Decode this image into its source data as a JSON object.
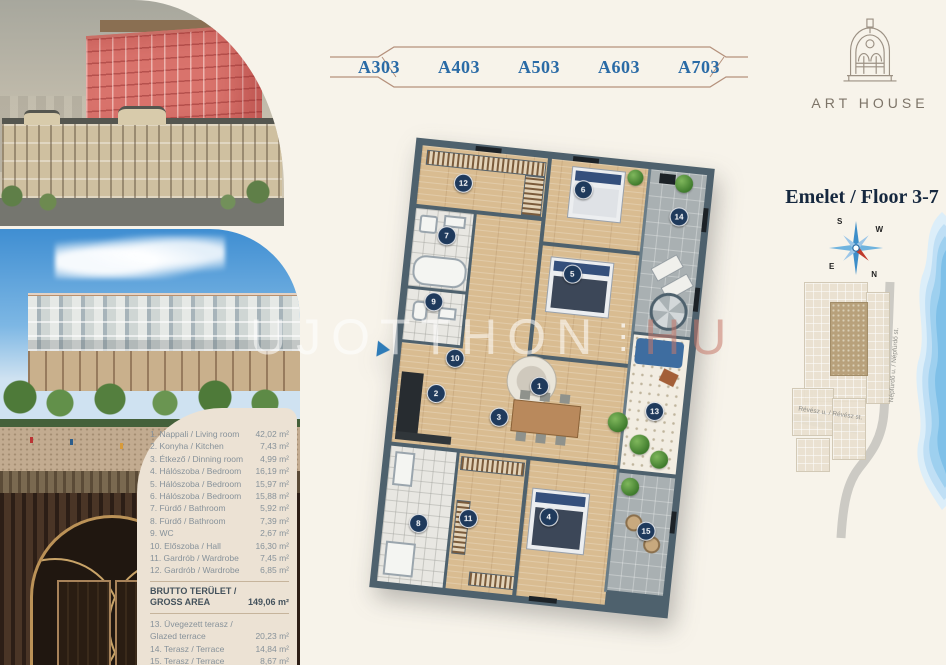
{
  "tabs": {
    "items": [
      {
        "label": "A303"
      },
      {
        "label": "A403"
      },
      {
        "label": "A503"
      },
      {
        "label": "A603"
      },
      {
        "label": "A703"
      }
    ]
  },
  "logo": {
    "text": "ART HOUSE"
  },
  "right_panel": {
    "title": "Emelet / Floor 3-7",
    "compass": {
      "n": "N",
      "s": "S",
      "e": "E",
      "w": "W"
    },
    "sitemap": {
      "street_vertical": "Népfürdő u. / Népfürdő st.",
      "street_horizontal": "Révész u. / Révész st."
    }
  },
  "watermark": {
    "main": "UJOTTHON",
    "dots": "⋮",
    "suffix": "HU"
  },
  "area_table": {
    "rows": [
      {
        "label": "1. Nappali / Living room",
        "area": "42,02 m²"
      },
      {
        "label": "2. Konyha / Kitchen",
        "area": "7,43 m²"
      },
      {
        "label": "3. Étkező / Dinning room",
        "area": "4,99 m²"
      },
      {
        "label": "4. Hálószoba / Bedroom",
        "area": "16,19 m²"
      },
      {
        "label": "5. Hálószoba / Bedroom",
        "area": "15,97 m²"
      },
      {
        "label": "6. Hálószoba / Bedroom",
        "area": "15,88 m²"
      },
      {
        "label": "7. Fürdő / Bathroom",
        "area": "5,92 m²"
      },
      {
        "label": "8. Fürdő / Bathroom",
        "area": "7,39 m²"
      },
      {
        "label": "9. WC",
        "area": "2,67 m²"
      },
      {
        "label": "10. Előszoba / Hall",
        "area": "16,30 m²"
      },
      {
        "label": "11. Gardrób / Wardrobe",
        "area": "7,45 m²"
      },
      {
        "label": "12. Gardrób / Wardrobe",
        "area": "6,85 m²"
      }
    ],
    "gross": {
      "label": "BRUTTO TERÜLET / GROSS AREA",
      "area": "149,06 m²"
    },
    "terrace_rows": [
      {
        "label": "13. Üvegezett terasz / Glazed terrace",
        "area": "20,23 m²"
      },
      {
        "label": "14. Terasz / Terrace",
        "area": "14,84 m²"
      },
      {
        "label": "15. Terasz / Terrace",
        "area": "8,67 m²"
      }
    ],
    "total": {
      "label": "Total",
      "area": "181,05 m²"
    }
  },
  "plan": {
    "markers": [
      "1",
      "2",
      "3",
      "4",
      "5",
      "6",
      "7",
      "8",
      "9",
      "10",
      "11",
      "12",
      "13",
      "14",
      "15"
    ]
  },
  "colors": {
    "tab_blue": "#2a6ba6",
    "title_navy": "#16283f",
    "frame_tan": "#b5917c",
    "marker_navy": "#1f3a5c",
    "panel_bg": "#ece2d4",
    "water_blue": "#7fc0e8",
    "north_red": "#c0392b"
  }
}
